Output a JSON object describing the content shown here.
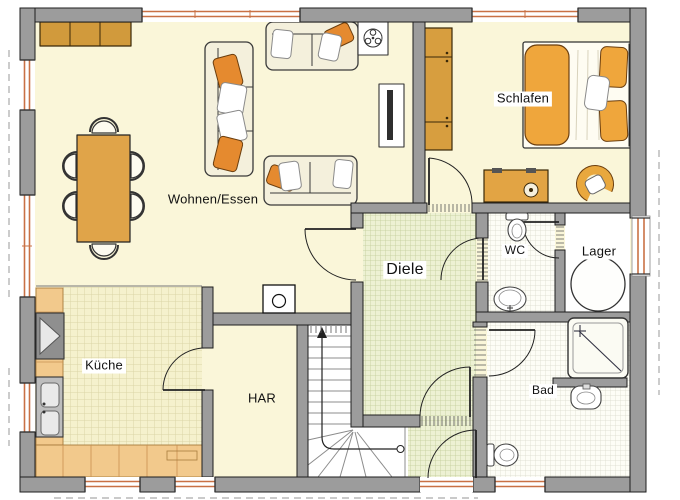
{
  "plan": {
    "type": "floor-plan",
    "rooms": [
      {
        "id": "wohnen-essen",
        "label": "Wohnen/Essen"
      },
      {
        "id": "schlafen",
        "label": "Schlafen"
      },
      {
        "id": "kueche",
        "label": "Küche"
      },
      {
        "id": "har",
        "label": "HAR"
      },
      {
        "id": "diele",
        "label": "Diele"
      },
      {
        "id": "wc",
        "label": "WC"
      },
      {
        "id": "lager",
        "label": "Lager"
      },
      {
        "id": "bad",
        "label": "Bad"
      }
    ],
    "colors": {
      "wall": "#9C9C9C",
      "floor": "#FAF6D9",
      "kitchen_tile": "#F5F1CD",
      "hall_tile": "#EDF1D3",
      "bath_tile": "#FDFDF6",
      "furniture_orange": "#E9A83E",
      "pillow_orange": "#E58A2F",
      "counter_tan": "#F2C98C",
      "window_frame": "#C97145",
      "outline": "#1E1E1E"
    }
  }
}
